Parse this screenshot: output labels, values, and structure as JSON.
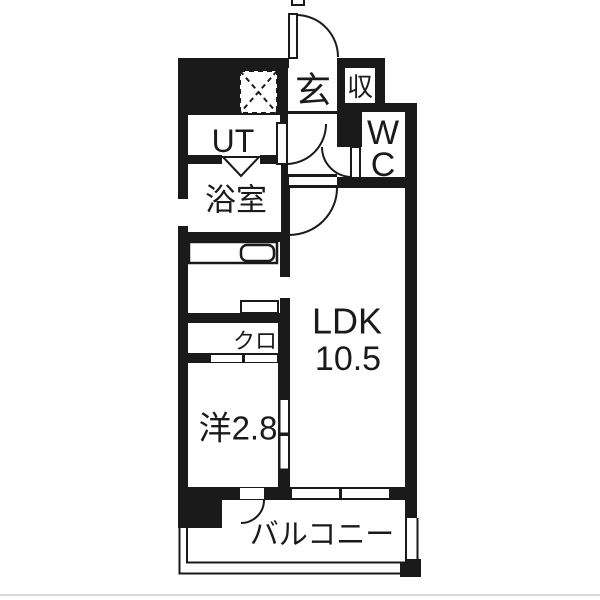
{
  "plan": {
    "name": "apartment-floor-plan",
    "colors": {
      "wall": "#1a1a1a",
      "background": "#ffffff",
      "baseline": "#d9d9d9"
    },
    "rooms": {
      "entrance": {
        "label": "玄"
      },
      "storage": {
        "label": "収"
      },
      "utility": {
        "label": "UT"
      },
      "toilet": {
        "line1": "W",
        "line2": "C"
      },
      "bathroom": {
        "label": "浴室"
      },
      "closet": {
        "label": "クロ"
      },
      "ldk": {
        "label": "LDK",
        "size": "10.5"
      },
      "western_room": {
        "label": "洋2.8"
      },
      "balcony": {
        "label": "バルコニー"
      }
    }
  }
}
